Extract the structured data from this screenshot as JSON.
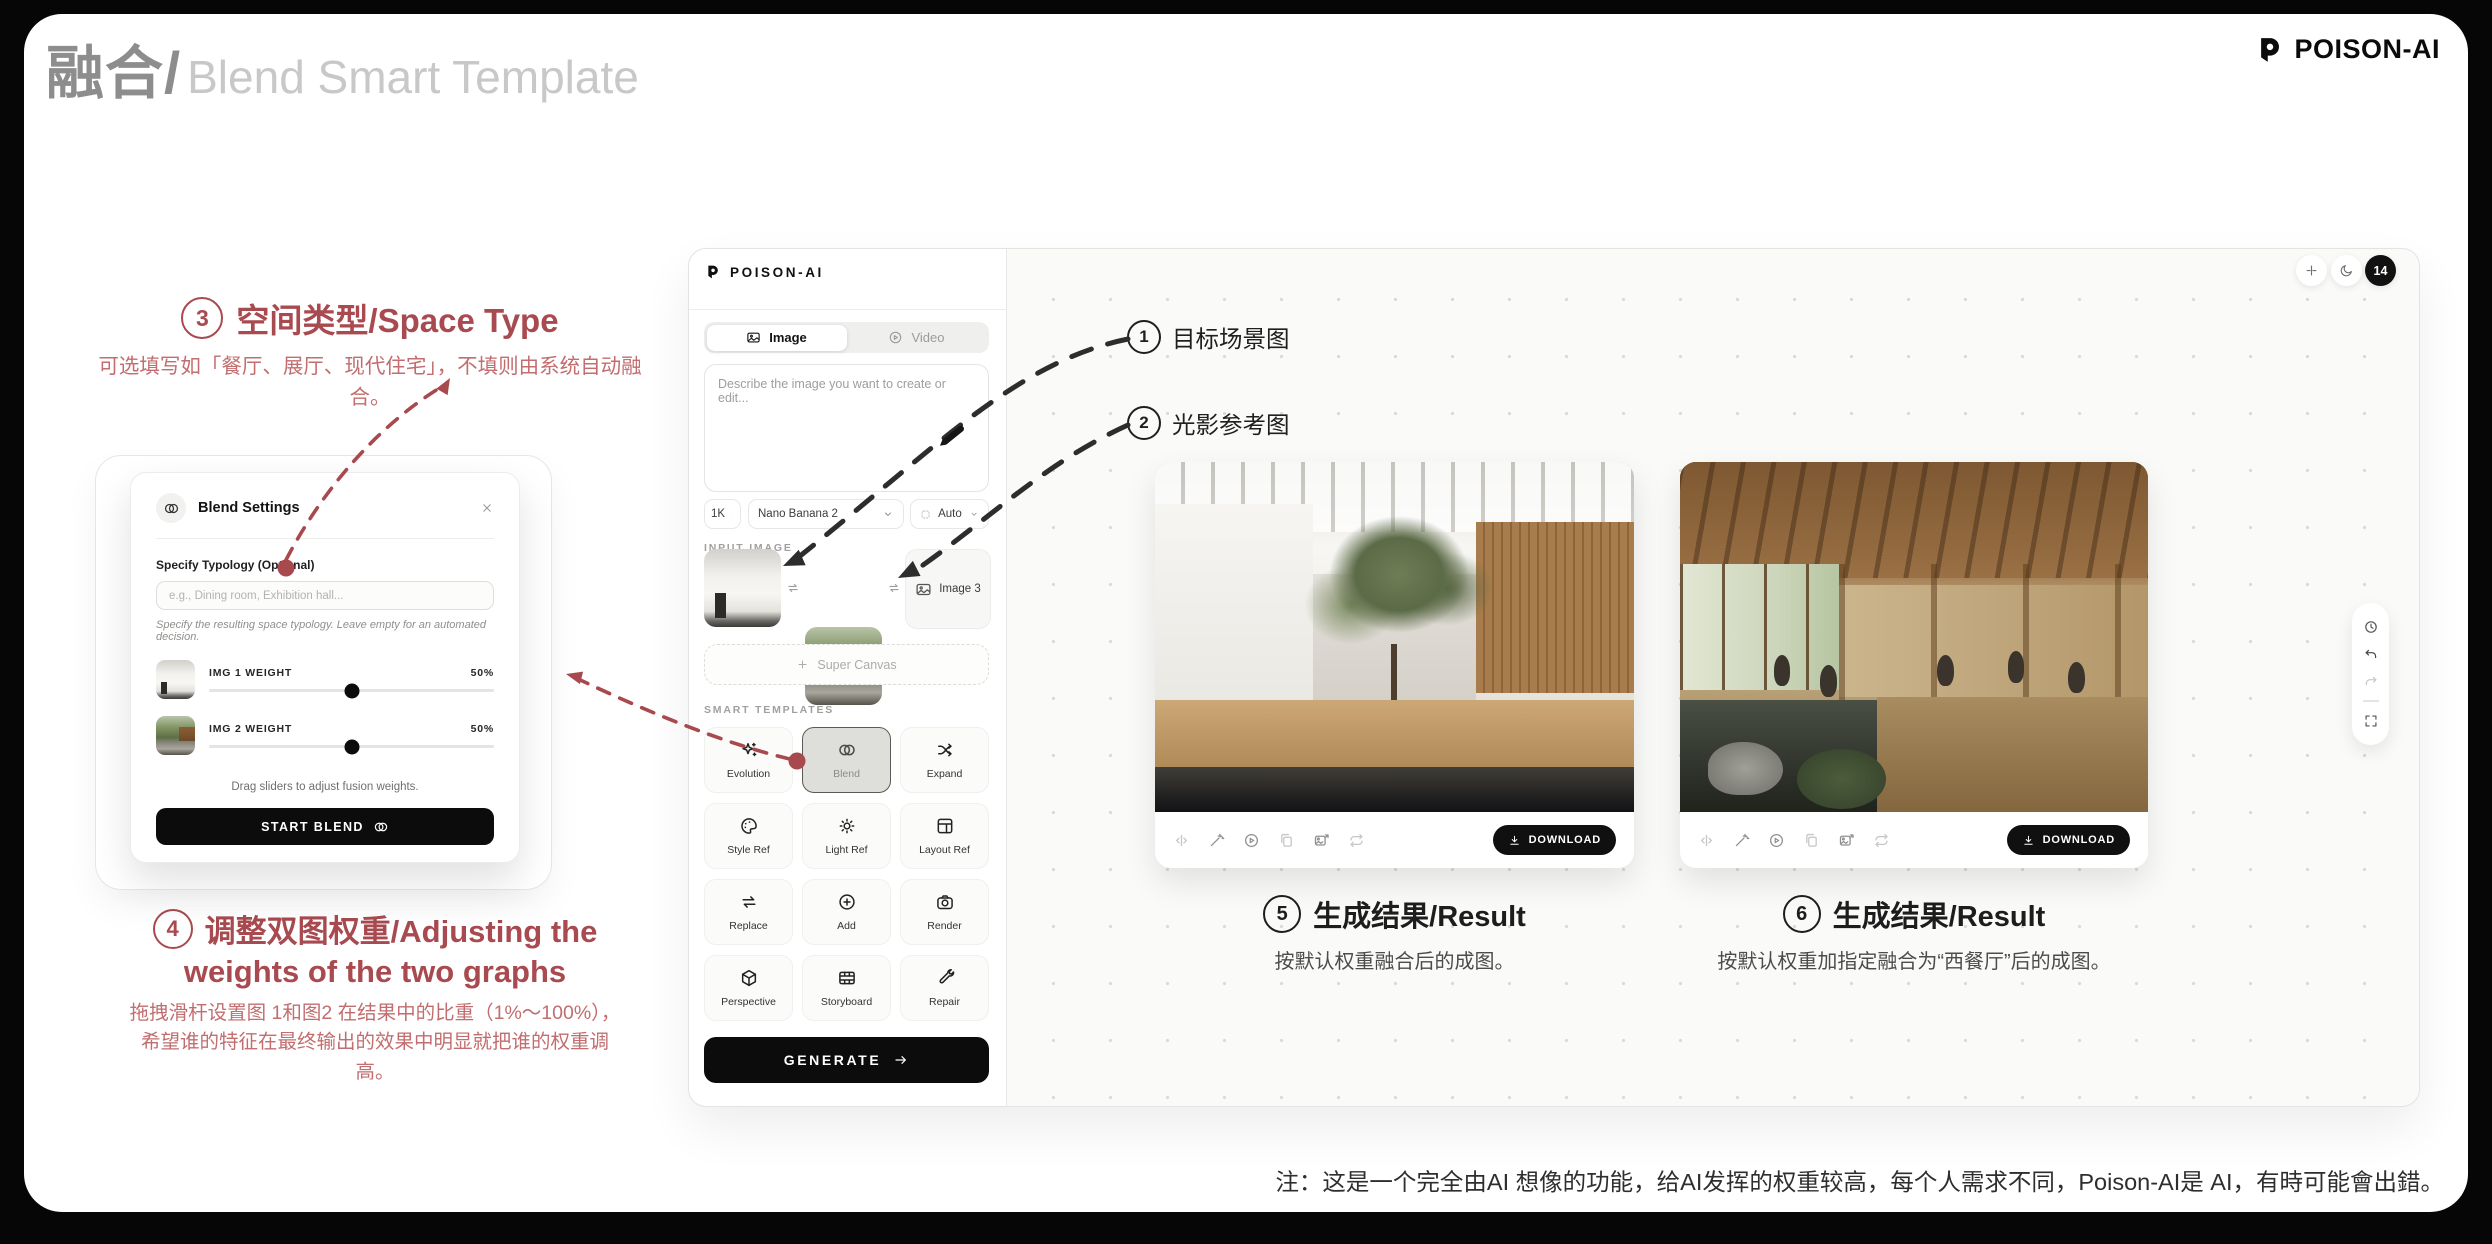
{
  "page": {
    "title_cn": "融合/",
    "title_en": "Blend Smart Template",
    "brand": "POISON-AI",
    "footer_note": "注：这是一个完全由AI 想像的功能，给AI发挥的权重较高，每个人需求不同，Poison-AI是 AI，有時可能會出錯。"
  },
  "colors": {
    "annotation_red": "#a84a4f",
    "annotation_red_light": "#c26d6f",
    "accent_black": "#0c0c0c",
    "canvas_bg": "#fafaf8"
  },
  "annotations": {
    "target_scene": {
      "num": "1",
      "label": "目标场景图"
    },
    "light_ref": {
      "num": "2",
      "label": "光影参考图"
    },
    "space_type": {
      "num": "3",
      "title": "空间类型/Space Type",
      "body": "可选填写如「餐厅、展厅、现代住宅」，不填则由系统自动融合。"
    },
    "weights": {
      "num": "4",
      "title_line1": "调整双图权重/Adjusting the",
      "title_line2": "weights of the two graphs",
      "body": "拖拽滑杆设置图 1和图2 在结果中的比重（1%～100%），希望谁的特征在最终输出的效果中明显就把谁的权重调高。"
    },
    "result_left": {
      "num": "5",
      "title": "生成结果/Result",
      "body": "按默认权重融合后的成图。"
    },
    "result_right": {
      "num": "6",
      "title": "生成结果/Result",
      "body": "按默认权重加指定融合为“西餐厅”后的成图。"
    }
  },
  "modal": {
    "icon": "blend-icon",
    "title": "Blend Settings",
    "close_icon": "close-icon",
    "typology_label": "Specify Typology (Optional)",
    "typology_placeholder": "e.g., Dining room, Exhibition hall...",
    "typology_help": "Specify the resulting space typology. Leave empty for an automated decision.",
    "sliders": [
      {
        "label": "IMG 1 WEIGHT",
        "value": "50%"
      },
      {
        "label": "IMG 2 WEIGHT",
        "value": "50%"
      }
    ],
    "hint": "Drag sliders to adjust fusion weights.",
    "start_button": "START BLEND"
  },
  "app": {
    "brand": "POISON-AI",
    "tabs": [
      {
        "label": "Image",
        "icon": "image-icon",
        "active": true
      },
      {
        "label": "Video",
        "icon": "play-icon",
        "active": false
      }
    ],
    "prompt_placeholder": "Describe the image you want to create or edit...",
    "selects": [
      {
        "label": "1K"
      },
      {
        "label": "Nano Banana 2"
      },
      {
        "label": "Auto",
        "icon": "dashed-square-icon"
      }
    ],
    "input_image_label": "INPUT IMAGE",
    "image3_label": "Image 3",
    "super_canvas_label": "Super Canvas",
    "smart_templates_label": "SMART TEMPLATES",
    "templates": [
      {
        "label": "Evolution",
        "icon": "sparkles-icon"
      },
      {
        "label": "Blend",
        "icon": "blend-icon",
        "selected": true
      },
      {
        "label": "Expand",
        "icon": "shuffle-icon"
      },
      {
        "label": "Style Ref",
        "icon": "palette-icon"
      },
      {
        "label": "Light Ref",
        "icon": "sun-icon"
      },
      {
        "label": "Layout Ref",
        "icon": "layout-icon"
      },
      {
        "label": "Replace",
        "icon": "swap-icon"
      },
      {
        "label": "Add",
        "icon": "plus-circle-icon"
      },
      {
        "label": "Render",
        "icon": "camera-icon"
      },
      {
        "label": "Perspective",
        "icon": "cube-icon"
      },
      {
        "label": "Storyboard",
        "icon": "film-icon"
      },
      {
        "label": "Repair",
        "icon": "wrench-icon"
      }
    ],
    "generate_label": "GENERATE",
    "download_label": "DOWNLOAD",
    "credits_badge": "14",
    "result_toolbar_icons": [
      "compare-icon",
      "wand-icon",
      "play-circle-icon",
      "copy-icon",
      "image-export-icon",
      "repeat-icon"
    ],
    "canvas_controls": [
      "fit-view-icon",
      "moon-icon",
      "credits-badge"
    ],
    "history_toolbar_icons": [
      "clock-icon",
      "undo-icon",
      "redo-icon",
      "expand-icon"
    ]
  }
}
